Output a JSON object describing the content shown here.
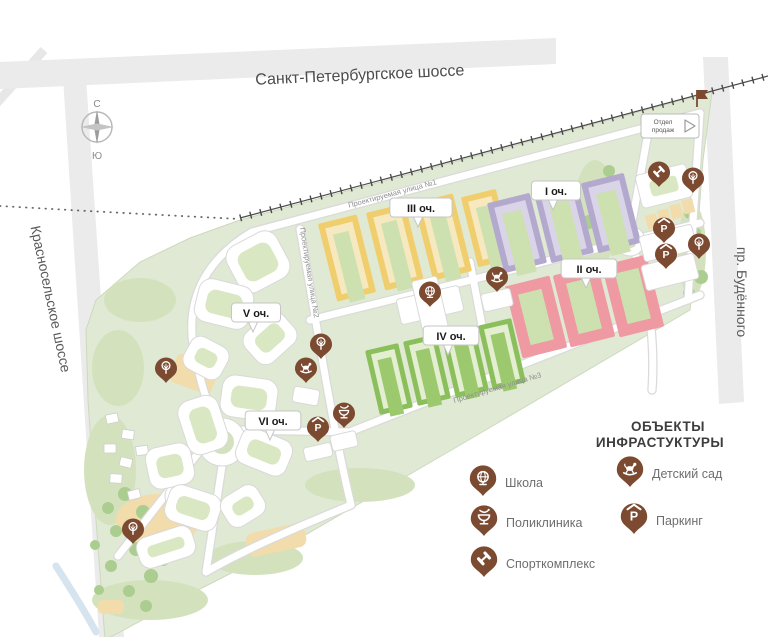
{
  "map": {
    "colors": {
      "pin": "#7b4a31",
      "map_green": "#e0e9d3",
      "phase1": "#b3a9ce",
      "phase2": "#ef99a3",
      "phase3": "#f0ce6d",
      "phase4": "#8abf5c"
    },
    "roads": {
      "top_highway": "Санкт-Петербургское шоссе",
      "left_road": "Красносельское шоссе",
      "right_road": "пр. Будённого",
      "street1": "Проектируемая улица №1",
      "street2": "Проектируемая улица №2",
      "street3": "Проектируемая улица №3"
    },
    "compass": {
      "north": "С",
      "south": "Ю"
    },
    "sales_office": {
      "line1": "Отдел",
      "line2": "продаж"
    },
    "phases": [
      {
        "label": "I оч.",
        "x": 556,
        "y": 191
      },
      {
        "label": "III оч.",
        "x": 421,
        "y": 208
      },
      {
        "label": "II оч.",
        "x": 589,
        "y": 269
      },
      {
        "label": "IV оч.",
        "x": 451,
        "y": 336
      },
      {
        "label": "V оч.",
        "x": 256,
        "y": 313
      },
      {
        "label": "VI оч.",
        "x": 273,
        "y": 421
      }
    ],
    "markers": [
      {
        "type": "sport",
        "x": 659,
        "y": 187
      },
      {
        "type": "tree",
        "x": 693,
        "y": 193
      },
      {
        "type": "parking",
        "x": 664,
        "y": 243
      },
      {
        "type": "parking",
        "x": 666,
        "y": 269
      },
      {
        "type": "tree",
        "x": 699,
        "y": 259
      },
      {
        "type": "kindergarten",
        "x": 497,
        "y": 292
      },
      {
        "type": "school",
        "x": 430,
        "y": 307
      },
      {
        "type": "tree",
        "x": 321,
        "y": 359
      },
      {
        "type": "kindergarten",
        "x": 306,
        "y": 383
      },
      {
        "type": "tree",
        "x": 166,
        "y": 383
      },
      {
        "type": "polyclinic",
        "x": 344,
        "y": 428
      },
      {
        "type": "parking",
        "x": 318,
        "y": 442
      },
      {
        "type": "tree",
        "x": 133,
        "y": 544
      }
    ]
  },
  "legend": {
    "title_line1": "ОБЪЕКТЫ",
    "title_line2": "ИНФРАСТУКТУРЫ",
    "items": [
      {
        "icon": "school-icon",
        "label": "Школа",
        "x": 483,
        "y": 483
      },
      {
        "icon": "polyclinic-icon",
        "label": "Поликлиника",
        "x": 484,
        "y": 523
      },
      {
        "icon": "sport-icon",
        "label": "Спорткомплекс",
        "x": 484,
        "y": 564
      },
      {
        "icon": "kindergarten-icon",
        "label": "Детский сад",
        "x": 630,
        "y": 474
      },
      {
        "icon": "parking-icon",
        "label": "Паркинг",
        "x": 634,
        "y": 521
      }
    ]
  }
}
